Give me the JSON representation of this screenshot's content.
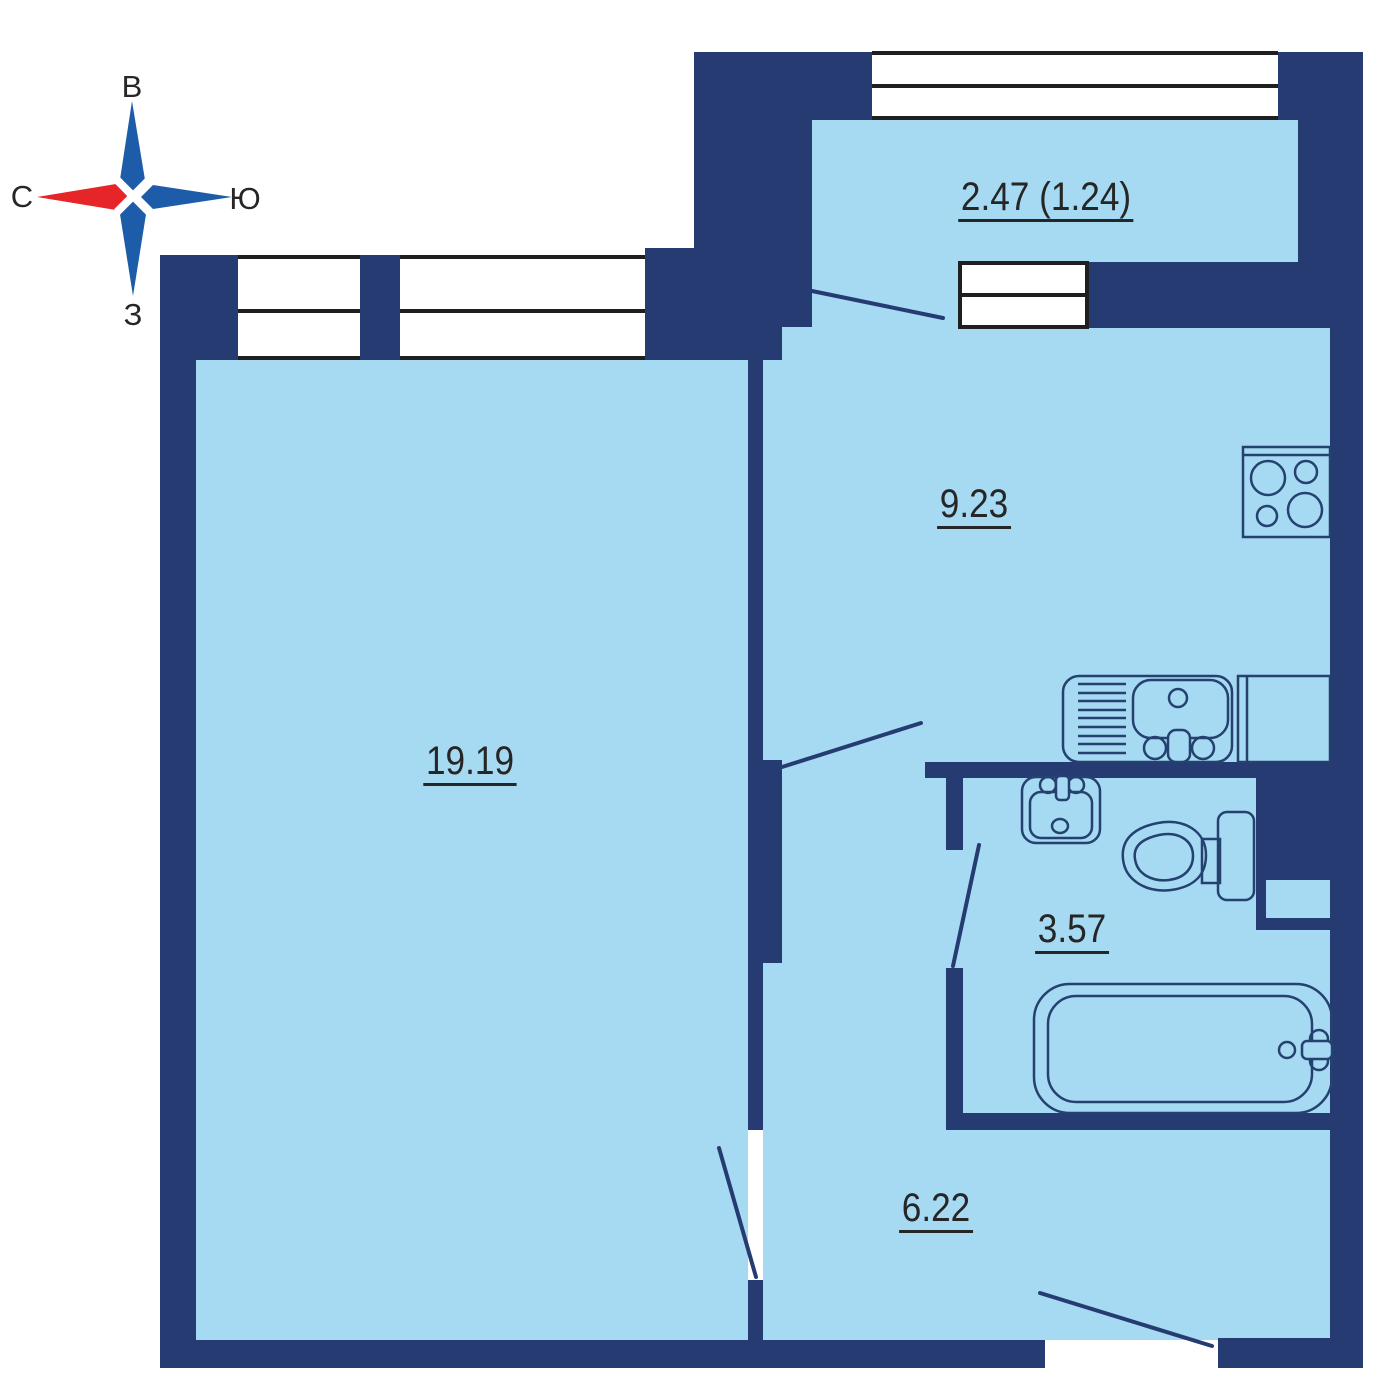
{
  "title": "Apartment floor plan",
  "compass": {
    "top_label": "В",
    "left_label": "С",
    "right_label": "Ю",
    "bottom_label": "З"
  },
  "rooms": {
    "balcony": {
      "area_label": "2.47 (1.24)"
    },
    "kitchen": {
      "area_label": "9.23"
    },
    "living_room": {
      "area_label": "19.19"
    },
    "bathroom": {
      "area_label": "3.57"
    },
    "hallway": {
      "area_label": "6.22"
    }
  },
  "fixtures": [
    "stove-icon",
    "kitchen-sink-icon",
    "kitchen-counter",
    "bathroom-sink-icon",
    "toilet-icon",
    "bathtub-icon"
  ],
  "colors": {
    "wall": "#253B72",
    "floor": "#A6D9F2",
    "fixture_outline": "#24416F",
    "window_line": "#1F1F1F",
    "text": "#262626",
    "compass_blue": "#1C5CA8",
    "compass_red": "#E52528",
    "background": "#FFFFFF"
  }
}
